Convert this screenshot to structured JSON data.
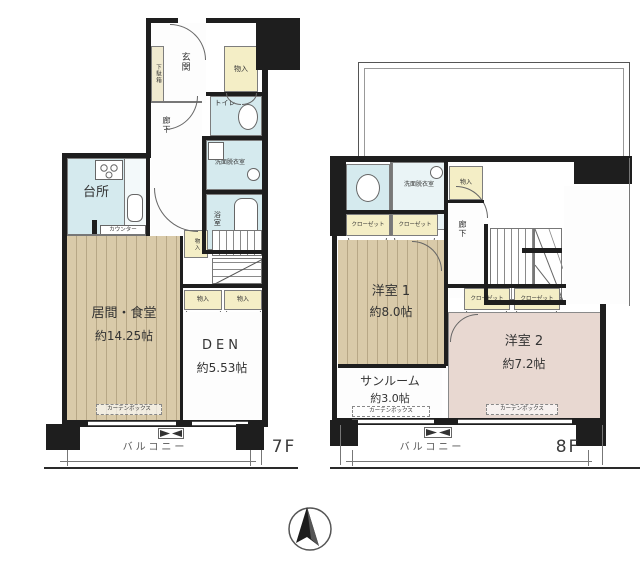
{
  "colors": {
    "wall": "#1e1e1e",
    "wood_floor": "#d9caa9",
    "wet_area": "#d5eaee",
    "closet_yellow": "#f4eec6",
    "room2_pink": "#e8d8d1",
    "label": "#333333"
  },
  "f7": {
    "floor_label": "7F",
    "genkan": "玄関",
    "getabako": "下駄箱",
    "monoire_entry": "物入",
    "toilet": "トイレ",
    "hallway": "廊下",
    "washroom": "洗面脱衣室",
    "bath": "浴室",
    "kitchen": "台所",
    "counter": "カウンター",
    "living_name": "居間・食堂",
    "living_size": "約14.25帖",
    "monoire_stair": "物入",
    "monoire_den_a": "物入",
    "monoire_den_b": "物入",
    "den_name": "DEN",
    "den_size": "約5.53帖",
    "curtain_box": "カーテンボックス",
    "balcony": "バルコニー"
  },
  "f8": {
    "floor_label": "8F",
    "toilet": "トイレ",
    "washroom": "洗面脱衣室",
    "monoire": "物入",
    "hallway": "廊下",
    "closet_a": "クローゼット",
    "closet_b": "クローゼット",
    "closet_c": "クローゼット",
    "closet_d": "クローゼット",
    "room1_name": "洋室 1",
    "room1_size": "約8.0帖",
    "room2_name": "洋室 2",
    "room2_size": "約7.2帖",
    "sunroom_name": "サンルーム",
    "sunroom_size": "約3.0帖",
    "curtain_box_a": "カーテンボックス",
    "curtain_box_b": "カーテンボックス",
    "balcony": "バルコニー"
  }
}
